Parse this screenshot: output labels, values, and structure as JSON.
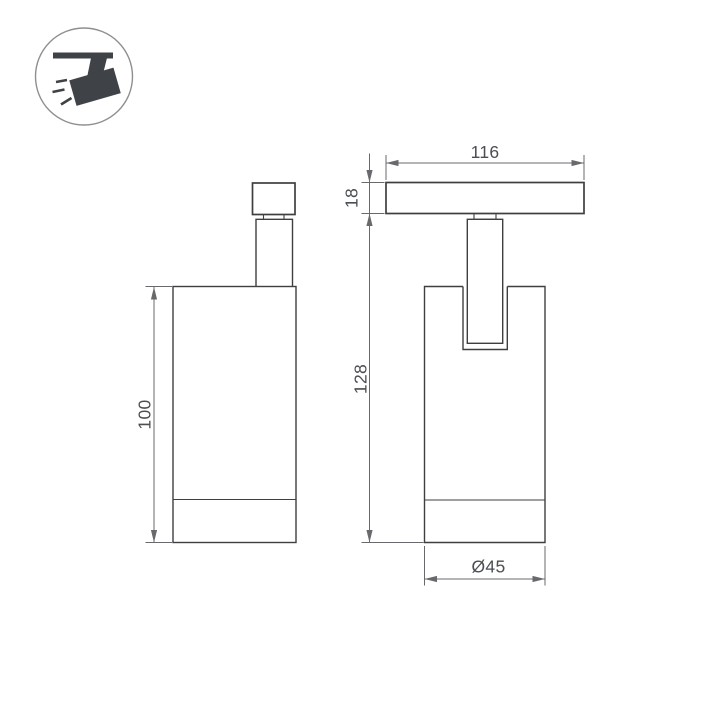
{
  "legend": {
    "icon": "track-spotlight"
  },
  "colors": {
    "object_line": "#3d3f41",
    "dimension_line": "#67696c",
    "dimension_text": "#4b4e52",
    "icon_fill": "#3f4347",
    "circle_outline": "#8d8f91",
    "background": "#ffffff"
  },
  "views": {
    "side": {
      "dims": {
        "body_height": "100"
      }
    },
    "front": {
      "dims": {
        "track_width": "116",
        "track_height": "18",
        "overall_height": "128",
        "diameter": "Ø45"
      }
    }
  }
}
